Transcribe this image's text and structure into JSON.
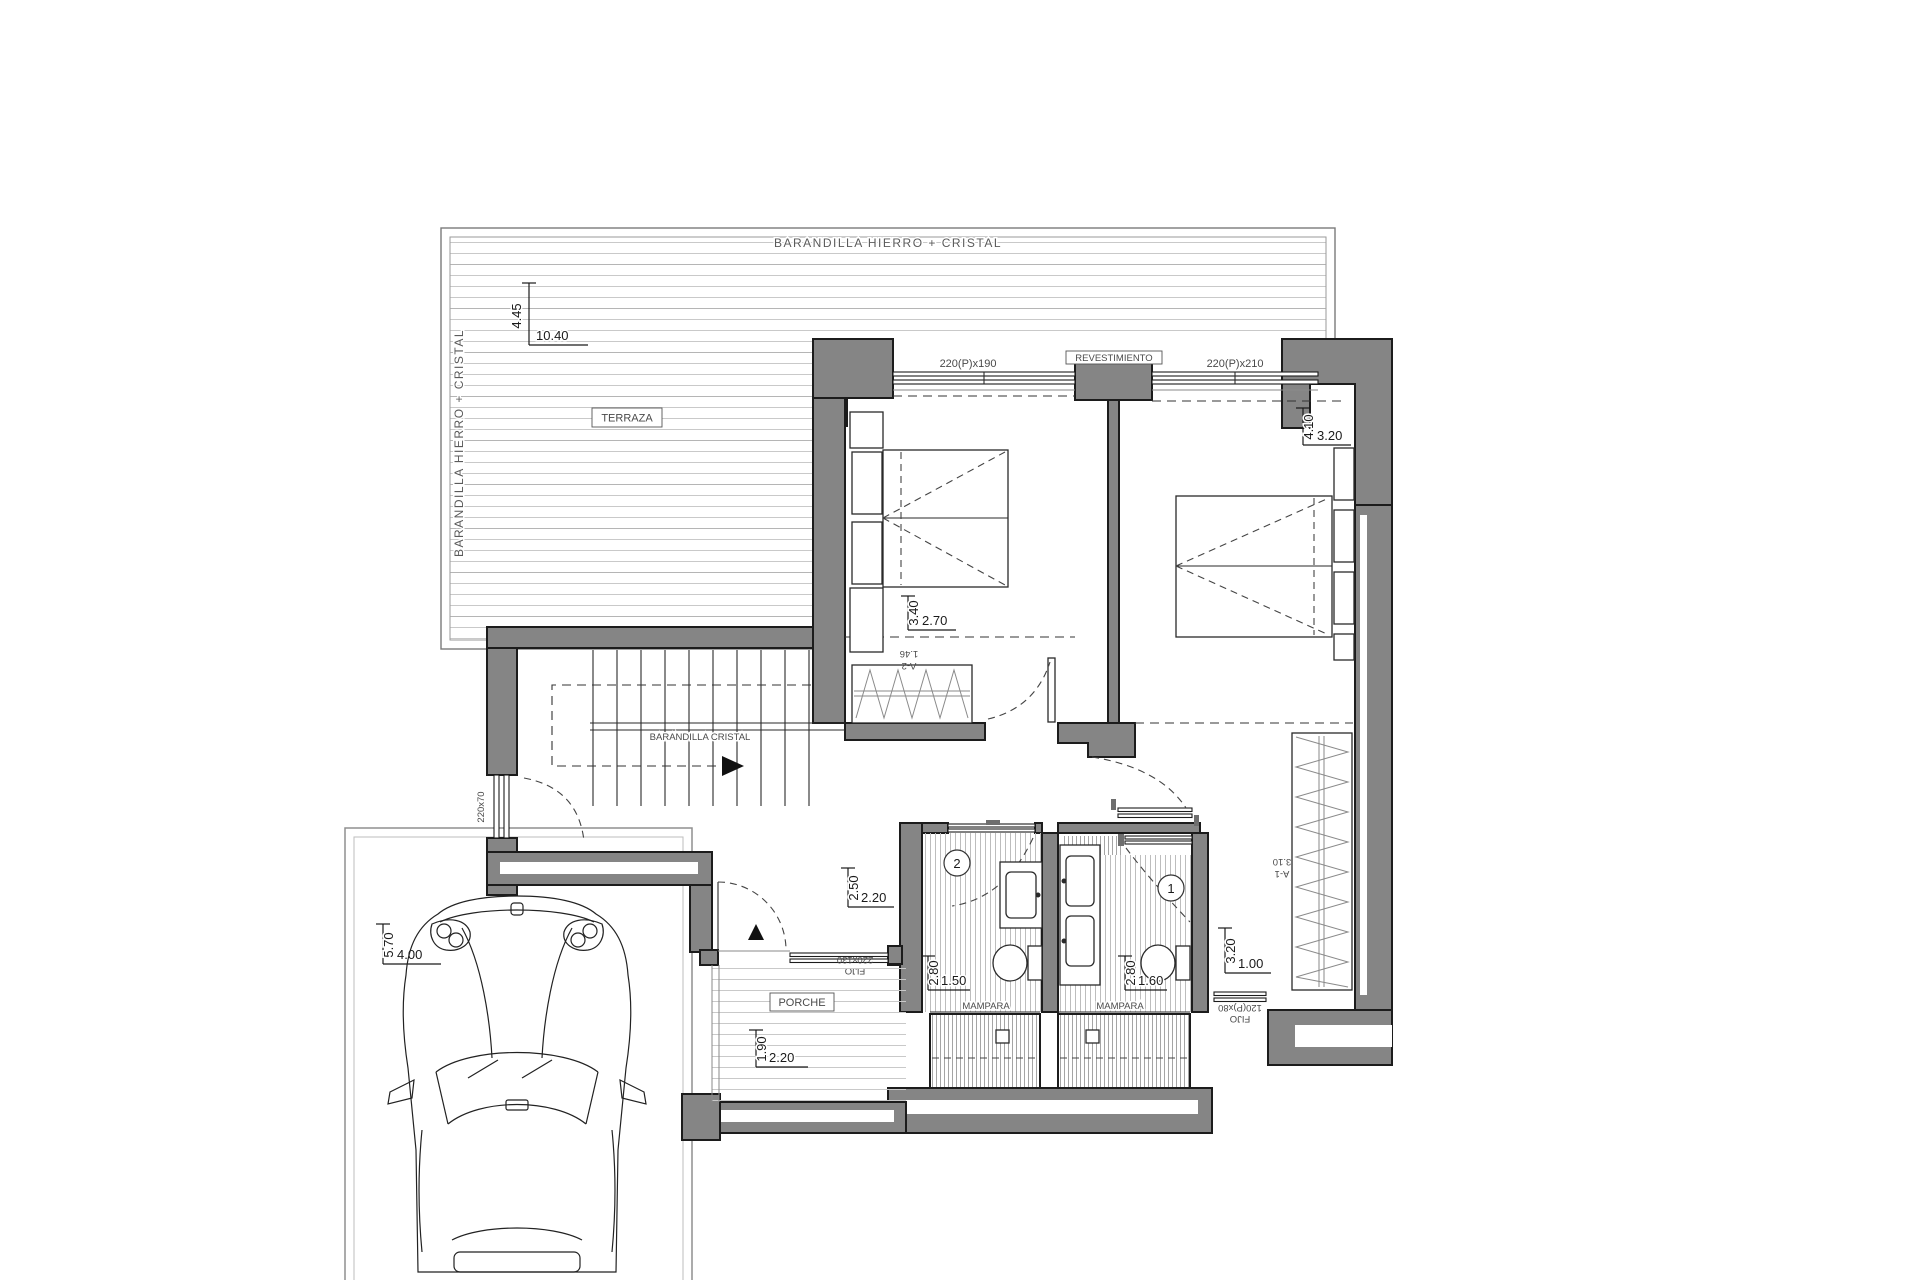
{
  "colors": {
    "wall_fill": "#858585",
    "outline": "#1c1c1c",
    "hatch_light": "#cdcdcd",
    "hatch_dark": "#a0a0a0",
    "dim_text": "#1a1a1a",
    "label_text": "#4a4a4a"
  },
  "terrace": {
    "label": "TERRAZA",
    "railing_top": "BARANDILLA HIERRO + CRISTAL",
    "railing_left": "BARANDILLA HIERRO + CRISTAL",
    "dim_v": "4.45",
    "dim_h": "10.40"
  },
  "stairs": {
    "railing": "BARANDILLA CRISTAL",
    "window": "220x70"
  },
  "bedroom1": {
    "window": "220(P)x190",
    "dim_v": "3.40",
    "dim_h": "2.70",
    "wardrobe_code": "A-2",
    "wardrobe_size": "1.46"
  },
  "bedroom2": {
    "window": "220(P)x210",
    "wall_label": "REVESTIMIENTO",
    "dim_v": "4.10",
    "dim_h": "3.20"
  },
  "hall": {
    "dim_v": "2.50",
    "dim_h": "2.20"
  },
  "bath1": {
    "number": "1",
    "dim_v": "2.80",
    "dim_h": "1.60",
    "screen": "MAMPARA"
  },
  "bath2": {
    "number": "2",
    "dim_v": "2.80",
    "dim_h": "1.50",
    "screen": "MAMPARA"
  },
  "dressing": {
    "dim_v": "3.20",
    "dim_h": "1.00",
    "wardrobe_code": "A-1",
    "wardrobe_size": "3.10",
    "window_line1": "FIJO",
    "window_line2": "120(P)x80"
  },
  "porch": {
    "label": "PORCHE",
    "dim_v": "1.90",
    "dim_h": "2.20",
    "entry_line1": "FIJO",
    "entry_line2": "220x130"
  },
  "parking": {
    "dim_v": "5.70",
    "dim_h": "4.00"
  }
}
